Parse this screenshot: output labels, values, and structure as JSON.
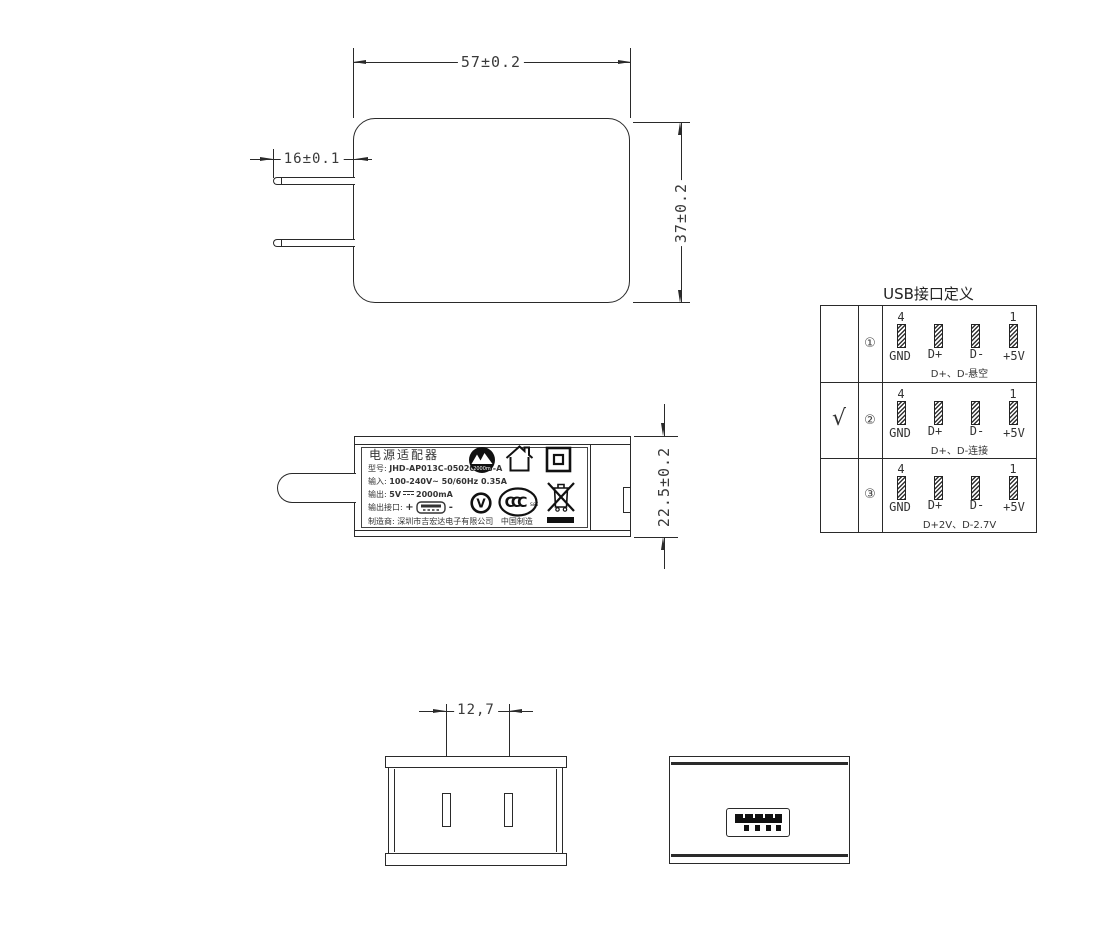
{
  "front_view": {
    "width_dim": "57±0.2",
    "height_dim": "37±0.2",
    "prong_dim": "16±0.1"
  },
  "side_view": {
    "height_dim": "22.5±0.2",
    "label": {
      "title": "电源适配器",
      "model_label": "型号:",
      "model_value": "JHD-AP013C-050200BB-A",
      "input_label": "输入:",
      "input_value": "100-240V~  50/60Hz  0.35A",
      "output_label": "输出:",
      "output_voltage": "5V",
      "output_current": "2000mA",
      "port_label": "输出接口:",
      "port_plus": "+",
      "port_minus": "-",
      "maker_label": "制造商:",
      "maker_value": "深圳市吉宏达电子有限公司",
      "origin": "中国制造",
      "altitude_text": "2000m",
      "efficiency_text": "V",
      "ccc_text": "CCC",
      "ccc_sub": "S&E"
    }
  },
  "usb_table": {
    "title": "USB接口定义",
    "rows": [
      {
        "check": "",
        "num": "①",
        "first_pin": "4",
        "last_pin": "1",
        "labels": [
          "GND",
          "D+",
          "D-",
          "+5V"
        ],
        "note": "D+、D-悬空"
      },
      {
        "check": "√",
        "num": "②",
        "first_pin": "4",
        "last_pin": "1",
        "labels": [
          "GND",
          "D+",
          "D-",
          "+5V"
        ],
        "note": "D+、D-连接"
      },
      {
        "check": "",
        "num": "③",
        "first_pin": "4",
        "last_pin": "1",
        "labels": [
          "GND",
          "D+",
          "D-",
          "+5V"
        ],
        "note": "D+2V、D-2.7V"
      }
    ]
  },
  "bottom_views": {
    "pin_spacing_dim": "12,7"
  }
}
